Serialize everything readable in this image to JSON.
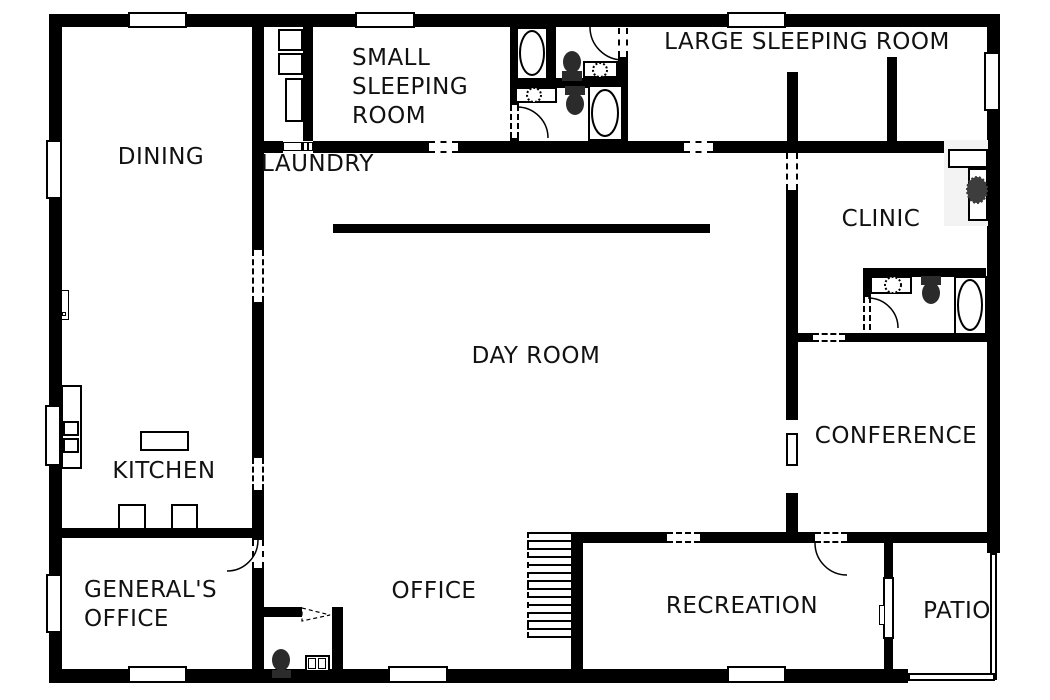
{
  "canvas": {
    "width": 1050,
    "height": 700,
    "background": "#ffffff",
    "wall_color": "#000000",
    "text_color": "#111111"
  },
  "rooms": {
    "dining": "DINING",
    "laundry": "LAUNDRY",
    "small_sleeping": {
      "line1": "SMALL",
      "line2": "SLEEPING",
      "line3": "ROOM"
    },
    "large_sleeping": "LARGE SLEEPING ROOM",
    "day_room": "DAY ROOM",
    "clinic": "CLINIC",
    "conference": "CONFERENCE",
    "kitchen": "KITCHEN",
    "generals_office": {
      "line1": "GENERAL'S",
      "line2": "OFFICE"
    },
    "office": "OFFICE",
    "recreation": "RECREATION",
    "patio": "PATIO"
  },
  "fixtures": {
    "icons": [
      "bathtub-icon",
      "toilet-icon",
      "sink-icon",
      "washer-icon",
      "dryer-icon",
      "ironing-board-icon",
      "stove-icon",
      "kitchen-island-icon",
      "stool-icon",
      "stairs-icon",
      "desk-icon",
      "chair-icon",
      "door-arc-icon",
      "window-icon",
      "patio-railing-icon"
    ]
  }
}
